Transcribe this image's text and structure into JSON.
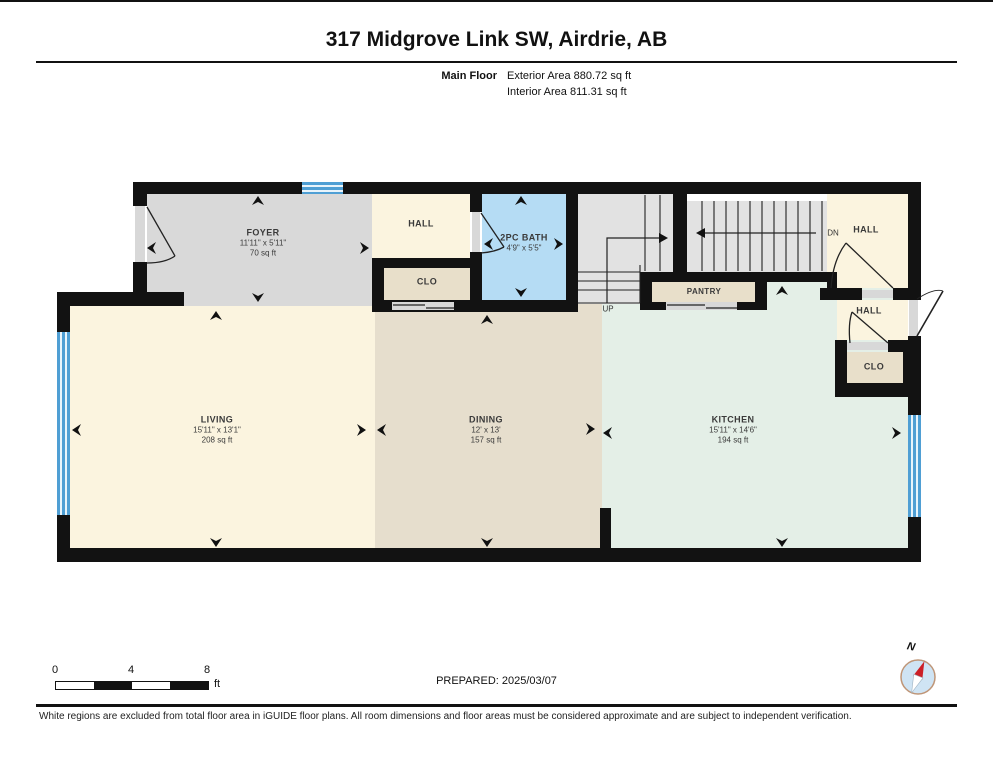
{
  "header": {
    "title": "317 Midgrove Link SW, Airdrie, AB",
    "floor_label": "Main Floor",
    "exterior_area": "Exterior Area 880.72 sq ft",
    "interior_area": "Interior Area 811.31 sq ft"
  },
  "rooms": [
    {
      "id": "foyer",
      "name": "FOYER",
      "dims": "11'11\" x 5'11\"",
      "area": "70 sq ft"
    },
    {
      "id": "hall-top",
      "name": "HALL"
    },
    {
      "id": "clo-foyer",
      "name": "CLO"
    },
    {
      "id": "bath",
      "name": "2PC BATH",
      "dims": "4'9\" x 5'5\""
    },
    {
      "id": "pantry",
      "name": "PANTRY"
    },
    {
      "id": "hall-upper-right",
      "name": "HALL"
    },
    {
      "id": "hall-mid-right",
      "name": "HALL"
    },
    {
      "id": "clo-right",
      "name": "CLO"
    },
    {
      "id": "living",
      "name": "LIVING",
      "dims": "15'11\" x 13'1\"",
      "area": "208 sq ft"
    },
    {
      "id": "dining",
      "name": "DINING",
      "dims": "12' x 13'",
      "area": "157 sq ft"
    },
    {
      "id": "kitchen",
      "name": "KITCHEN",
      "dims": "15'11\" x 14'6\"",
      "area": "194 sq ft"
    }
  ],
  "stairs": {
    "up_label": "UP",
    "down_label": "DN"
  },
  "scale_bar": {
    "ticks": [
      "0",
      "4",
      "8"
    ],
    "unit": "ft"
  },
  "footer": {
    "prepared": "PREPARED: 2025/03/07",
    "compass_label": "N",
    "disclaimer": "White regions are excluded from total floor area in iGUIDE floor plans. All room dimensions and floor areas must be considered approximate and are subject to independent verification."
  },
  "colors": {
    "wall": "#121212",
    "foyer_floor": "#d9d9d9",
    "hall_floor": "#fbf4df",
    "closet_floor": "#e8dfca",
    "dining_floor": "#e6decd",
    "bath_floor": "#b5dcf4",
    "kitchen_floor": "#e4efe7",
    "stair_floor": "#e2e2e2",
    "window": "#4f9fd4",
    "door_panel": "#d8d8d8",
    "compass_face": "#cfe4f4",
    "compass_ring": "#bf9678",
    "compass_needle": "#cc2027"
  }
}
